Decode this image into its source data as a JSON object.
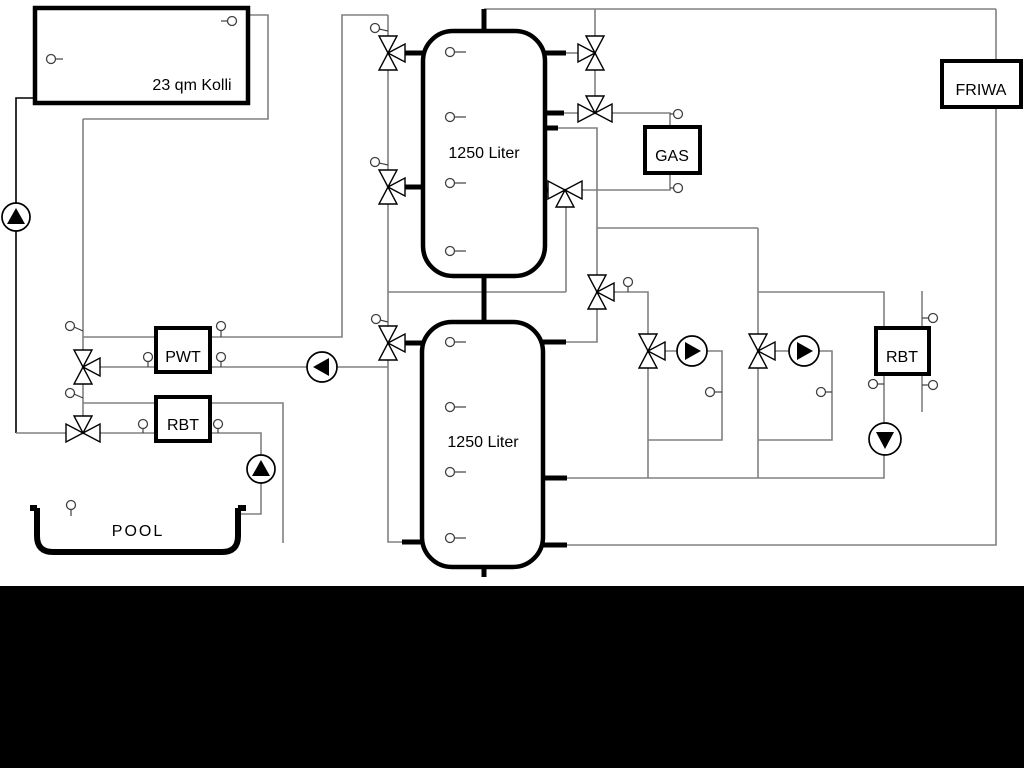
{
  "diagram": {
    "labels": {
      "collector": "23 qm Kolli",
      "buffer_tank_top": "1250 Liter",
      "buffer_tank_bottom": "1250 Liter",
      "pwt": "PWT",
      "rbt_left": "RBT",
      "gas": "GAS",
      "friwa": "FRIWA",
      "rbt_right": "RBT",
      "pool": "POOL"
    },
    "colors": {
      "background": "#ffffff",
      "pipe": "#808080",
      "line": "#000000",
      "sensor": "#404040",
      "band": "#000000"
    }
  }
}
